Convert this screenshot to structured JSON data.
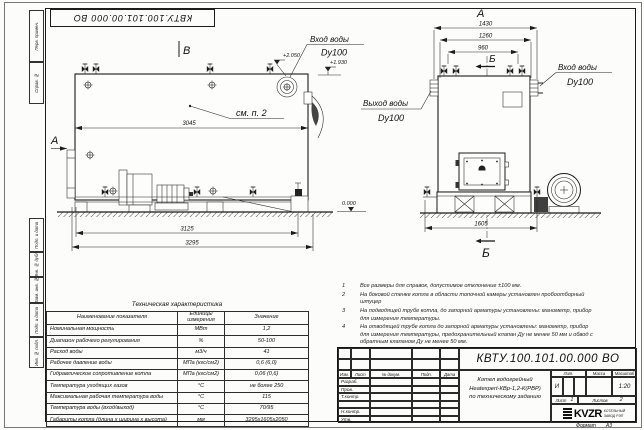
{
  "sheet": {
    "stamp_top": "КВТУ.100.101.00.000 ВО",
    "format_label": "Формат",
    "format_value": "А3",
    "margin": {
      "perv": "Перв. примен.",
      "sprav": "Справ. №",
      "podp1": "Подп. и дата",
      "inv_dubl": "Инв. № дубл.",
      "vzam": "Взам. инв. №",
      "podp2": "Подп. и дата",
      "inv_podl": "Инв. № подл."
    }
  },
  "side_view": {
    "view_label": "В",
    "arrow_label": "А",
    "see_note": "см. п. 2",
    "dim_body": "3045",
    "dim_frame": "3125",
    "dim_overall": "3295",
    "inlet_label": "Вход воды",
    "inlet_dn": "Dy100",
    "elev_inlet": "+2.050",
    "elev_outlet": "+1.930",
    "elev_zero": "0.000"
  },
  "front_view": {
    "view_label": "А",
    "section_label_top": "Б",
    "section_label_bottom": "Б",
    "dim_overall": "1430",
    "dim_mid": "1260",
    "dim_valves": "960",
    "dim_width": "1605",
    "inlet_label": "Вход воды",
    "inlet_dn": "Dy100",
    "outlet_label": "Выход воды",
    "outlet_dn": "Dy100"
  },
  "notes": {
    "items": [
      {
        "num": "1",
        "text": "Все размеры для справок, допустимое отклонение ±100 мм."
      },
      {
        "num": "2",
        "text": "На боковой стенке котла в области топочной камеры установлен пробоотборный штуцер"
      },
      {
        "num": "3",
        "text": "На подводящей трубе котла, до запорной арматуры установлены: манометр, прибор для измерения температуры."
      },
      {
        "num": "4",
        "text": "На отводящей трубе котла до запорной арматуры установлены: манометр, прибор для измерения температуры, предохранительный клапан Ду не менее 50 мм и обвод с обратным клапаном Ду не менее 50 мм."
      }
    ]
  },
  "tech_table": {
    "title": "Техническая характеристика",
    "headers": [
      "Наименование показателя",
      "Единицы измерения",
      "Значение"
    ],
    "rows": [
      [
        "Номинальная мощность",
        "МВт",
        "1,2"
      ],
      [
        "Диапазон рабочего регулирования",
        "%",
        "50-100"
      ],
      [
        "Расход воды",
        "м3/ч",
        "41"
      ],
      [
        "Рабочее давление воды",
        "МПа (кгс/см2)",
        "0,6 (6,0)"
      ],
      [
        "Гидравлическое сопротивление котла",
        "МПа (кгс/см2)",
        "0,06 (0,6)"
      ],
      [
        "Температура уходящих газов",
        "°С",
        "не более 250"
      ],
      [
        "Максимальная рабочая температура воды",
        "°С",
        "115"
      ],
      [
        "Температура воды (вход/выход)",
        "°С",
        "70/95"
      ],
      [
        "Габариты котла (длина х ширина х высота)",
        "мм",
        "3295х1605х2050"
      ]
    ]
  },
  "title_block": {
    "doc_number": "КВТУ.100.101.00.000  ВО",
    "header_cols": [
      "Изм.",
      "Лист",
      "№ докум.",
      "Подп.",
      "Дата"
    ],
    "sig_rows": [
      "Разраб.",
      "Пров.",
      "Т.контр.",
      "",
      "Н.контр.",
      "Утв."
    ],
    "product_lines": [
      "Котел водогрейный",
      "Heatexpert-КВр-1,2-К(РВР)",
      "по техническому заданию"
    ],
    "lit_label": "Лит.",
    "mass_label": "Масса",
    "scale_label": "Масштаб",
    "lit_value": "И",
    "scale_value": "1:20",
    "sheet_label": "Лист",
    "sheet_value": "1",
    "sheets_label": "Листов",
    "sheets_value": "2",
    "logo_text": "KVZR",
    "company_line1": "КОТЕЛЬНЫЙ",
    "company_line2": "ЗАВОД РЭП"
  }
}
